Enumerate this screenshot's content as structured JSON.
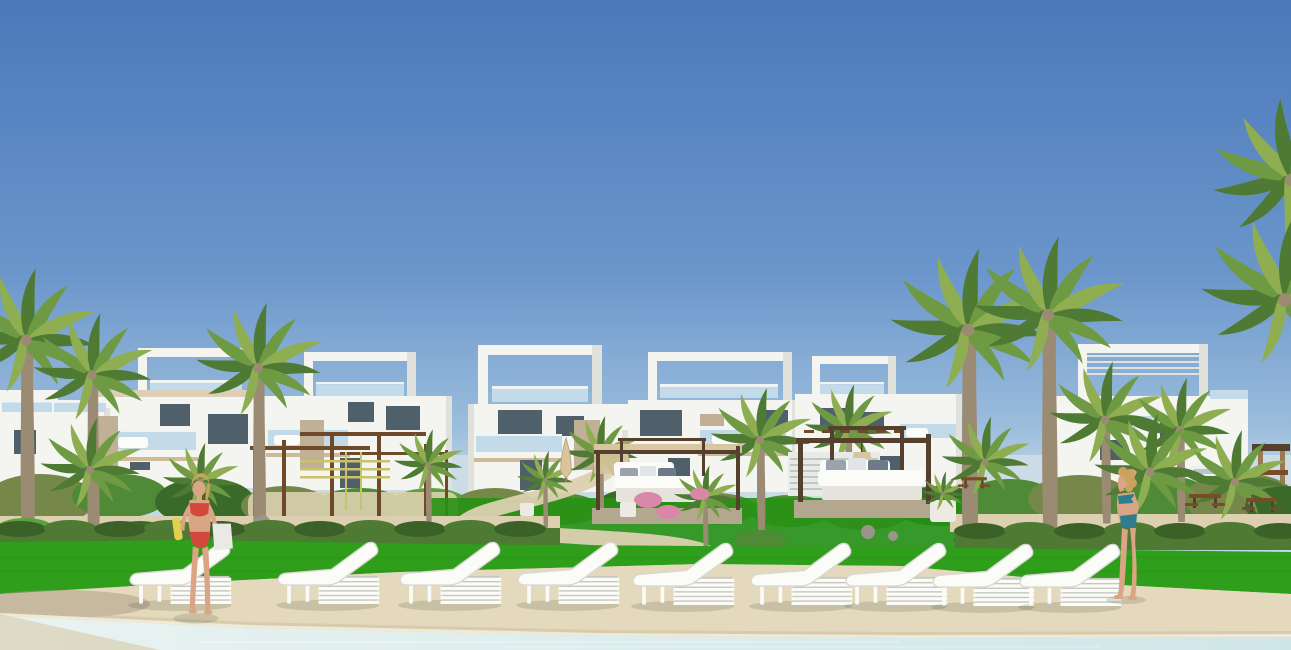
{
  "scene": {
    "description": "Sunny architectural rendering of a modern white villa resort: a row of two-storey cubic villas with rooftop frame pergolas and glass balconies, palm trees and landscaped gardens, a bright lawn, a sandy pool deck lined with nine white sun loungers, two day-bed cabanas, an outdoor fitness pergola, picnic tables, and two women in bikinis standing at the edge of a pale turquoise swimming pool.",
    "setting": "residential resort pool area",
    "time_of_day": "midday, clear blue sky",
    "inventory": {
      "villas": 6,
      "sun_loungers": 9,
      "cabana_daybeds": 2,
      "people": 2,
      "tall_palm_trees": 6,
      "small_palms": 10,
      "parasols_closed": 2,
      "picnic_tables": 3,
      "fitness_pergola": 1,
      "white_van_distant": 1,
      "wooden_tower_distant": 1
    },
    "people": [
      {
        "id": "woman-left",
        "pose": "standing facing viewer beside loungers",
        "swimsuit": "red bikini",
        "hair": "blonde tied back",
        "carrying": "white towel bag and yellow towel"
      },
      {
        "id": "woman-right",
        "pose": "standing in profile, hand raised to brow, looking up",
        "swimsuit": "teal bikini",
        "hair": "blonde curly"
      }
    ]
  },
  "colors": {
    "sky_top": "#4a79ba",
    "sky_mid": "#6b96cb",
    "sky_low": "#9cbedd",
    "sky_horizon": "#c3d9e9",
    "distant": "#ccdce6",
    "wall": "#f4f4f1",
    "wall_shade": "#dfe1da",
    "wall_dark": "#c9cdc5",
    "glass": "#c3dbe8",
    "rail": "#f0f4f5",
    "window": "#50606b",
    "tan": "#d4c3a2",
    "stone": "#bfb096",
    "soffit": "#cdbb98",
    "trunk": "#9b8b72",
    "palm1": "#4f7a33",
    "palm2": "#6f9a44",
    "palm3": "#8fae52",
    "bush_olive": "#75884a",
    "bush_mid": "#4f8a36",
    "bush_dark": "#3a6a2a",
    "bush_bright": "#5ba23a",
    "grass": "#2f9e1b",
    "grass_deep": "#279114",
    "hedge": "#4e7a33",
    "hedge_dark": "#3c6128",
    "sand": "#dcd0b0",
    "deck": "#e4d9bd",
    "deck_wet": "#c9bc9e",
    "deck_stain": "#a89a82",
    "coping": "#f0e9d6",
    "pool_near": "#cfe6e8",
    "pool_far": "#e9f3f1",
    "pool_sand": "#d5c9a8",
    "white": "#fbfbf8",
    "lounger_under": "#d8d8d2",
    "slatbox": "#c7c7c0",
    "wood": "#6e4a2a",
    "wood_dark": "#54402c",
    "wood_mid": "#7b4a26",
    "platform": "#b3a88f",
    "canopy_tan": "#d8c49e",
    "pillow1": "#9aa3ab",
    "pillow2": "#e2e5e7",
    "pillow3": "#6d7a88",
    "planter": "#eceae2",
    "skin": "#d9a584",
    "hair": "#c9a35f",
    "bikini_red": "#d2493c",
    "bikini_teal": "#2e7d8f",
    "towel": "#e9e9e5",
    "towel_yellow": "#e3cf4e",
    "van": "#eef0f0",
    "kiosk": "#9a7a52",
    "rock": "#9a958a",
    "flower": "#d887a8",
    "bar_yellow": "#c9c26a",
    "louver": "#e7eae6",
    "louver_line": "#c2c7c1"
  }
}
